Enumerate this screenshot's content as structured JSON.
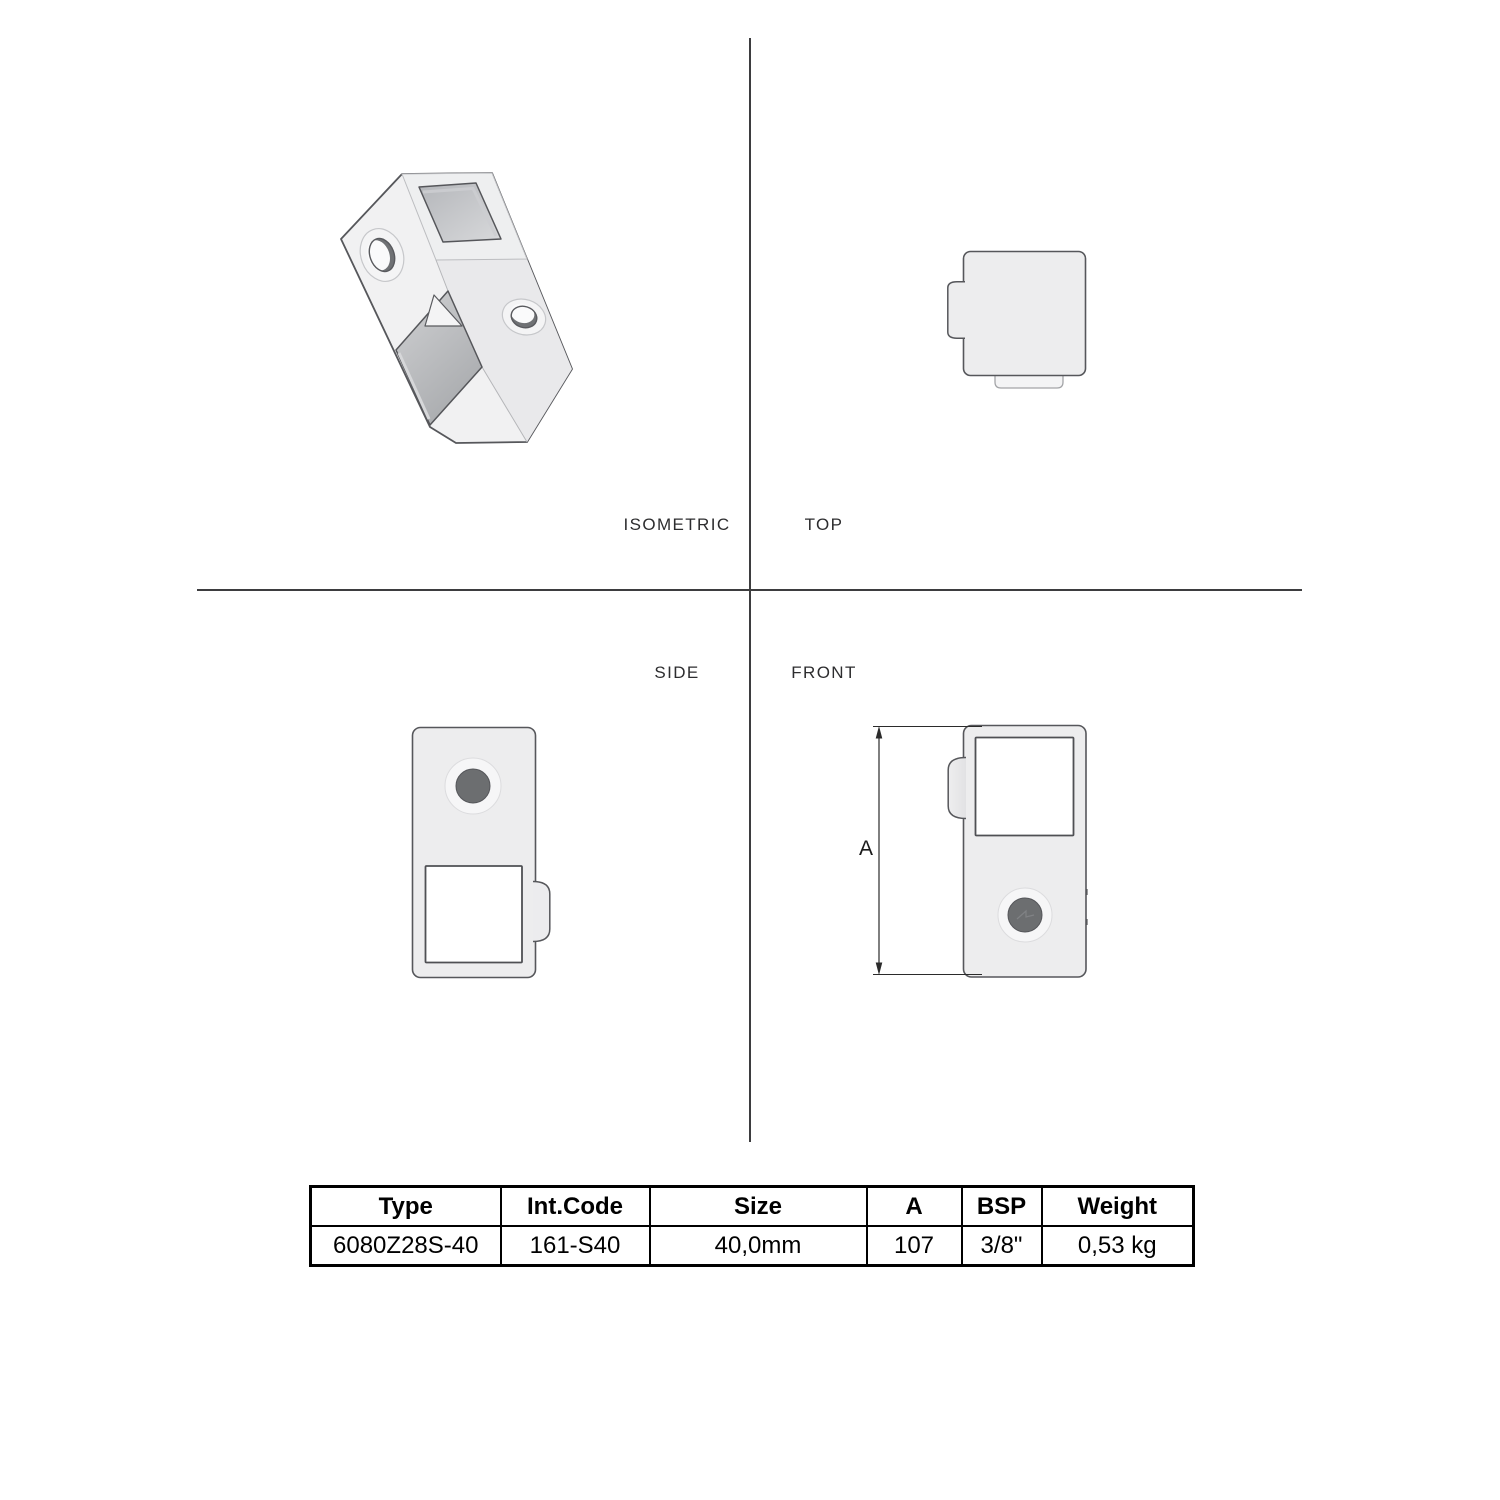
{
  "views": {
    "isometric": "ISOMETRIC",
    "top": "TOP",
    "side": "SIDE",
    "front": "FRONT"
  },
  "dimension": {
    "label": "A"
  },
  "table": {
    "headers": [
      "Type",
      "Int.Code",
      "Size",
      "A",
      "BSP",
      "Weight"
    ],
    "row": [
      "6080Z28S-40",
      "161-S40",
      "40,0mm",
      "107",
      "3/8\"",
      "0,53 kg"
    ]
  },
  "colors": {
    "background": "#ffffff",
    "outline": "#56575b",
    "body_fill": "#ededee",
    "hole_gray": "#c0c2c5",
    "screw_hole_dark": "#6c6e70",
    "divider_line": "#3d3d3f",
    "table_border": "#000000",
    "label_text": "#2d2d2f"
  }
}
